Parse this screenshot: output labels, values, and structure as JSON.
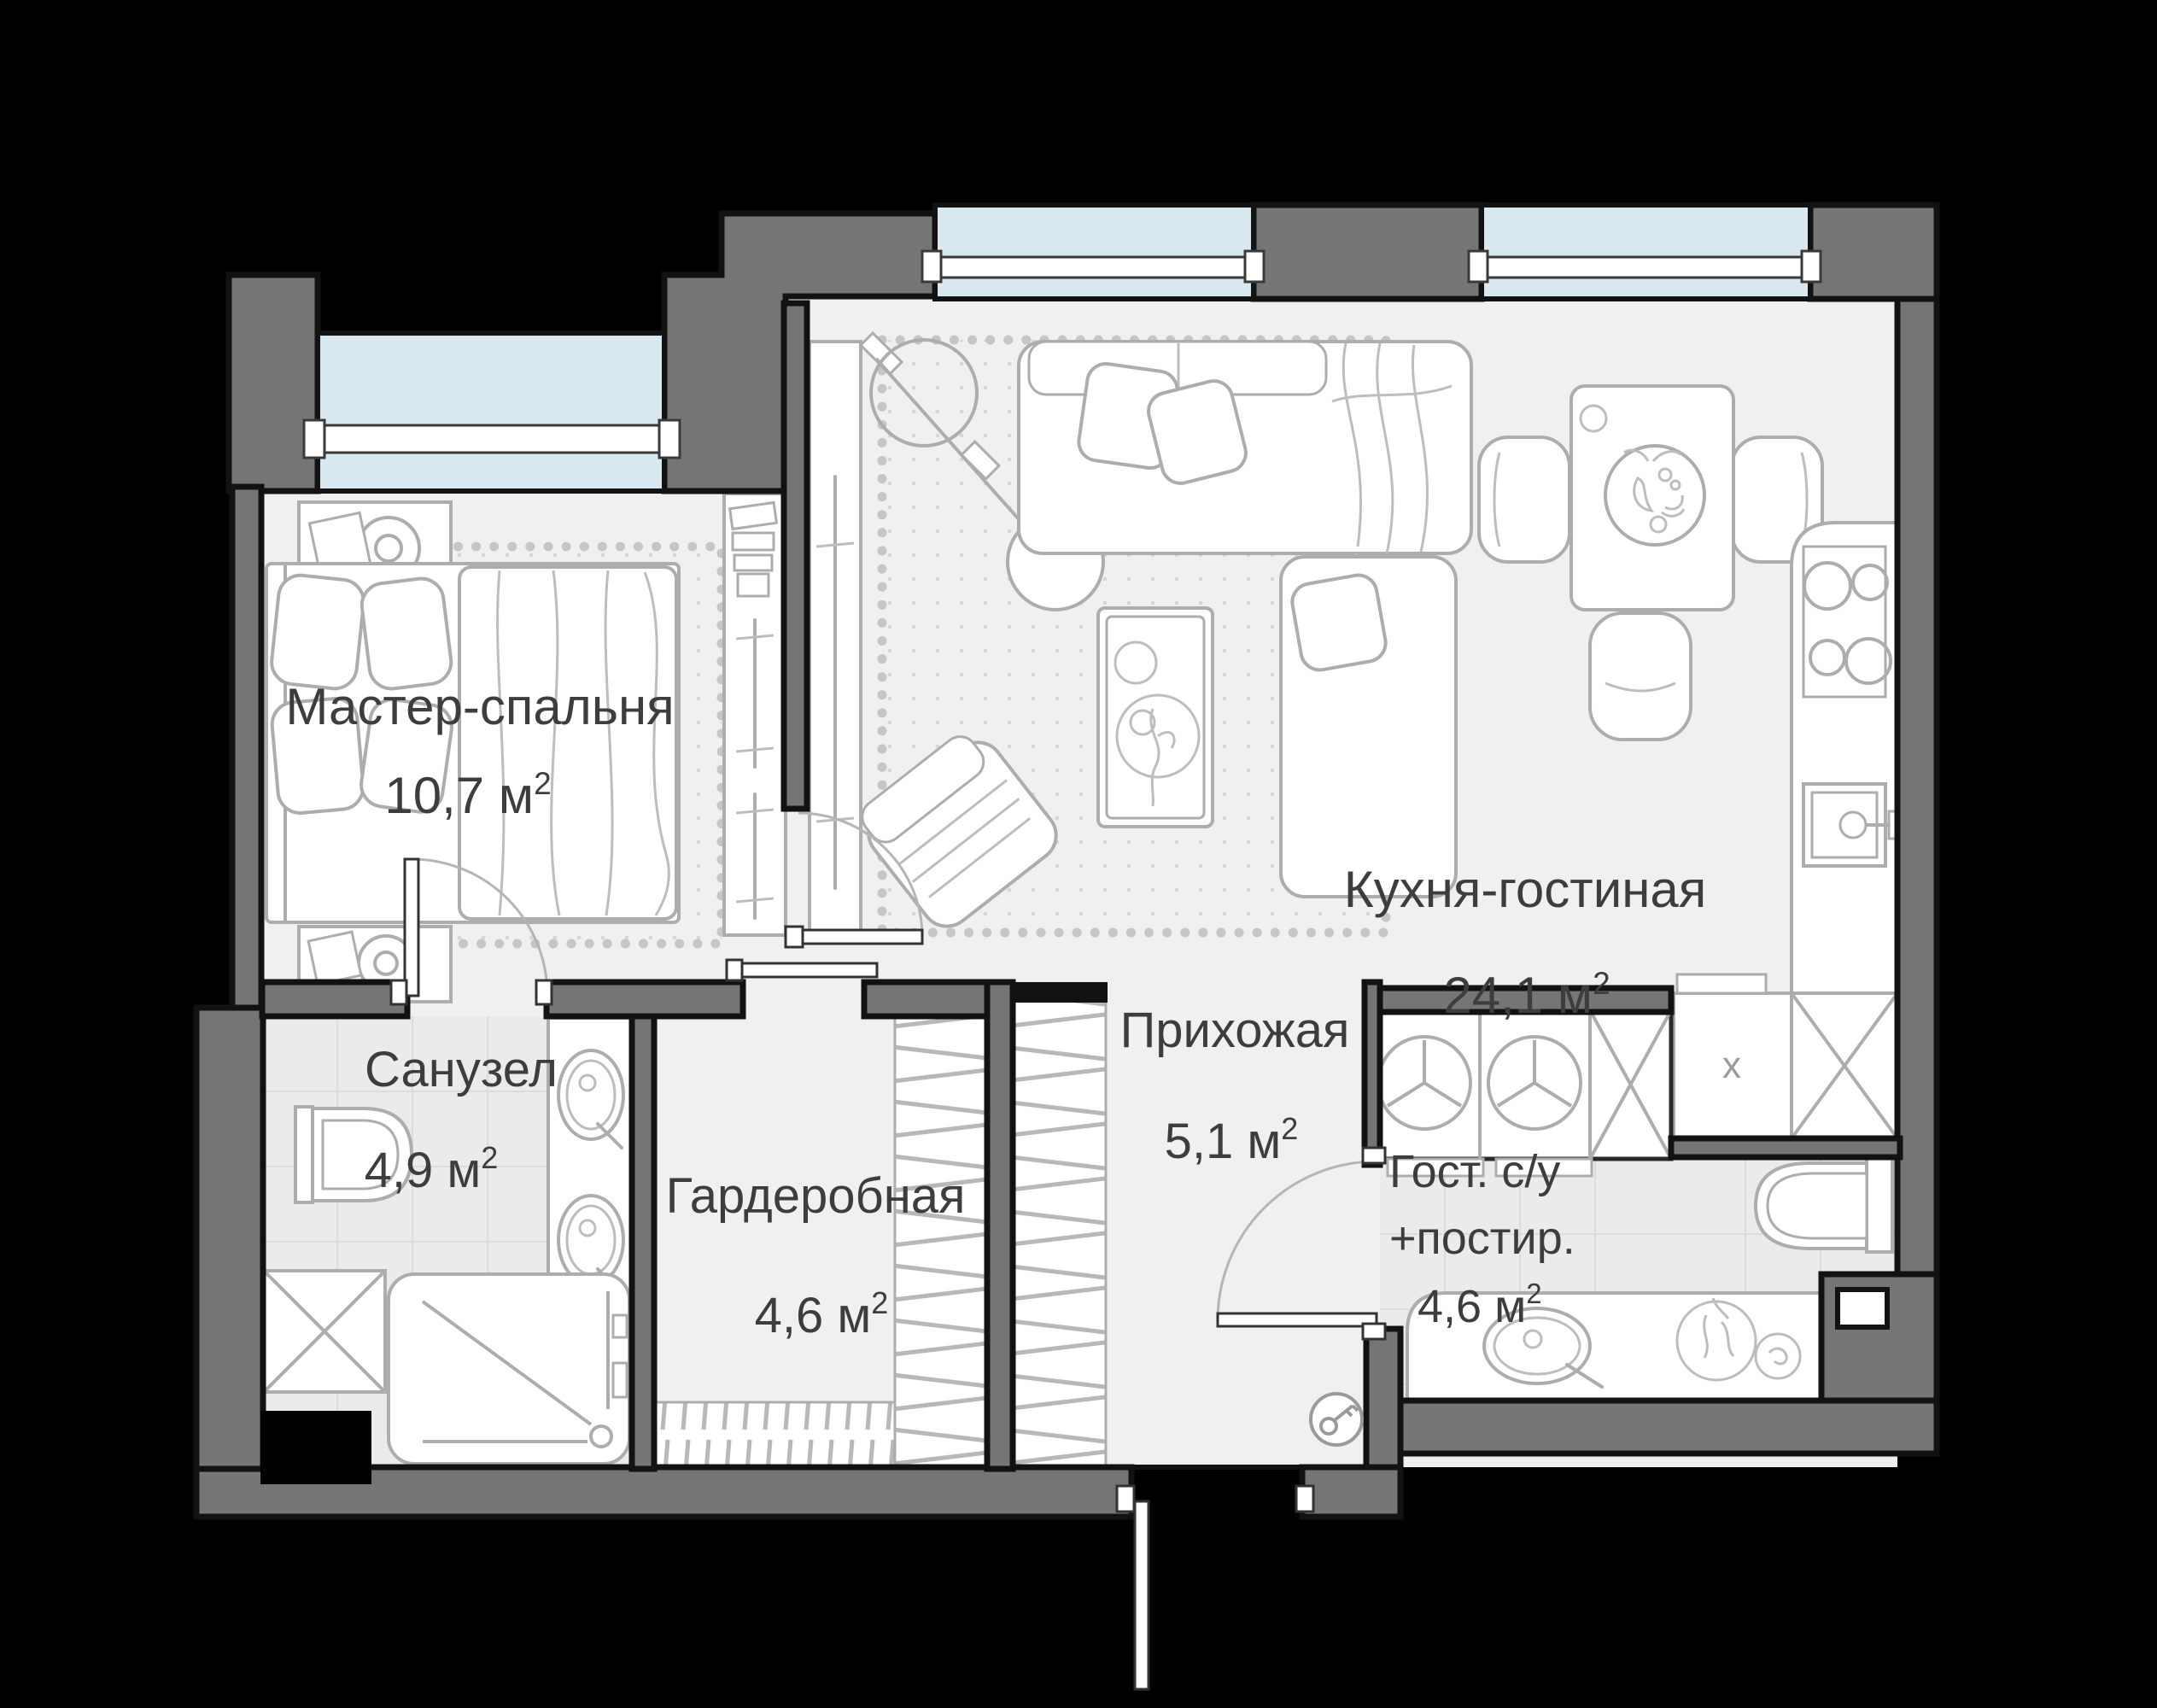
{
  "plan": {
    "rooms": [
      {
        "id": "master-bedroom",
        "name": "Мастер-спальня",
        "area_value": "10,7",
        "area_unit": "м",
        "area_sup": "2"
      },
      {
        "id": "kitchen-living",
        "name": "Кухня-гостиная",
        "area_value": "24,1",
        "area_unit": "м",
        "area_sup": "2"
      },
      {
        "id": "bathroom",
        "name": "Санузел",
        "area_value": "4,9",
        "area_unit": "м",
        "area_sup": "2"
      },
      {
        "id": "wardrobe",
        "name": "Гардеробная",
        "area_value": "4,6",
        "area_unit": "м",
        "area_sup": "2"
      },
      {
        "id": "hallway",
        "name": "Прихожая",
        "area_value": "5,1",
        "area_unit": "м",
        "area_sup": "2"
      },
      {
        "id": "guest-bathroom",
        "name": "Гост. с/у",
        "name_line2": "+постир.",
        "area_value": "4,6",
        "area_unit": "м",
        "area_sup": "2"
      }
    ],
    "markers": {
      "kitchen_cabinet": "x"
    },
    "colors": {
      "background": "#000000",
      "wall": "#757575",
      "wall_outline": "#121212",
      "floor": "#f0f0f0",
      "tile": "#ebebeb",
      "window_glass": "#d9e8f0",
      "furniture_line": "#adadad",
      "plant_fill": "#8cc5a5",
      "plant_stroke": "#57a47c",
      "label_text": "#3d3d3d"
    },
    "icons": [
      "washing-machine-icon",
      "key-icon",
      "monstera-plant-icon",
      "stove-burners-icon",
      "sink-icon",
      "shower-icon",
      "toilet-icon"
    ]
  }
}
